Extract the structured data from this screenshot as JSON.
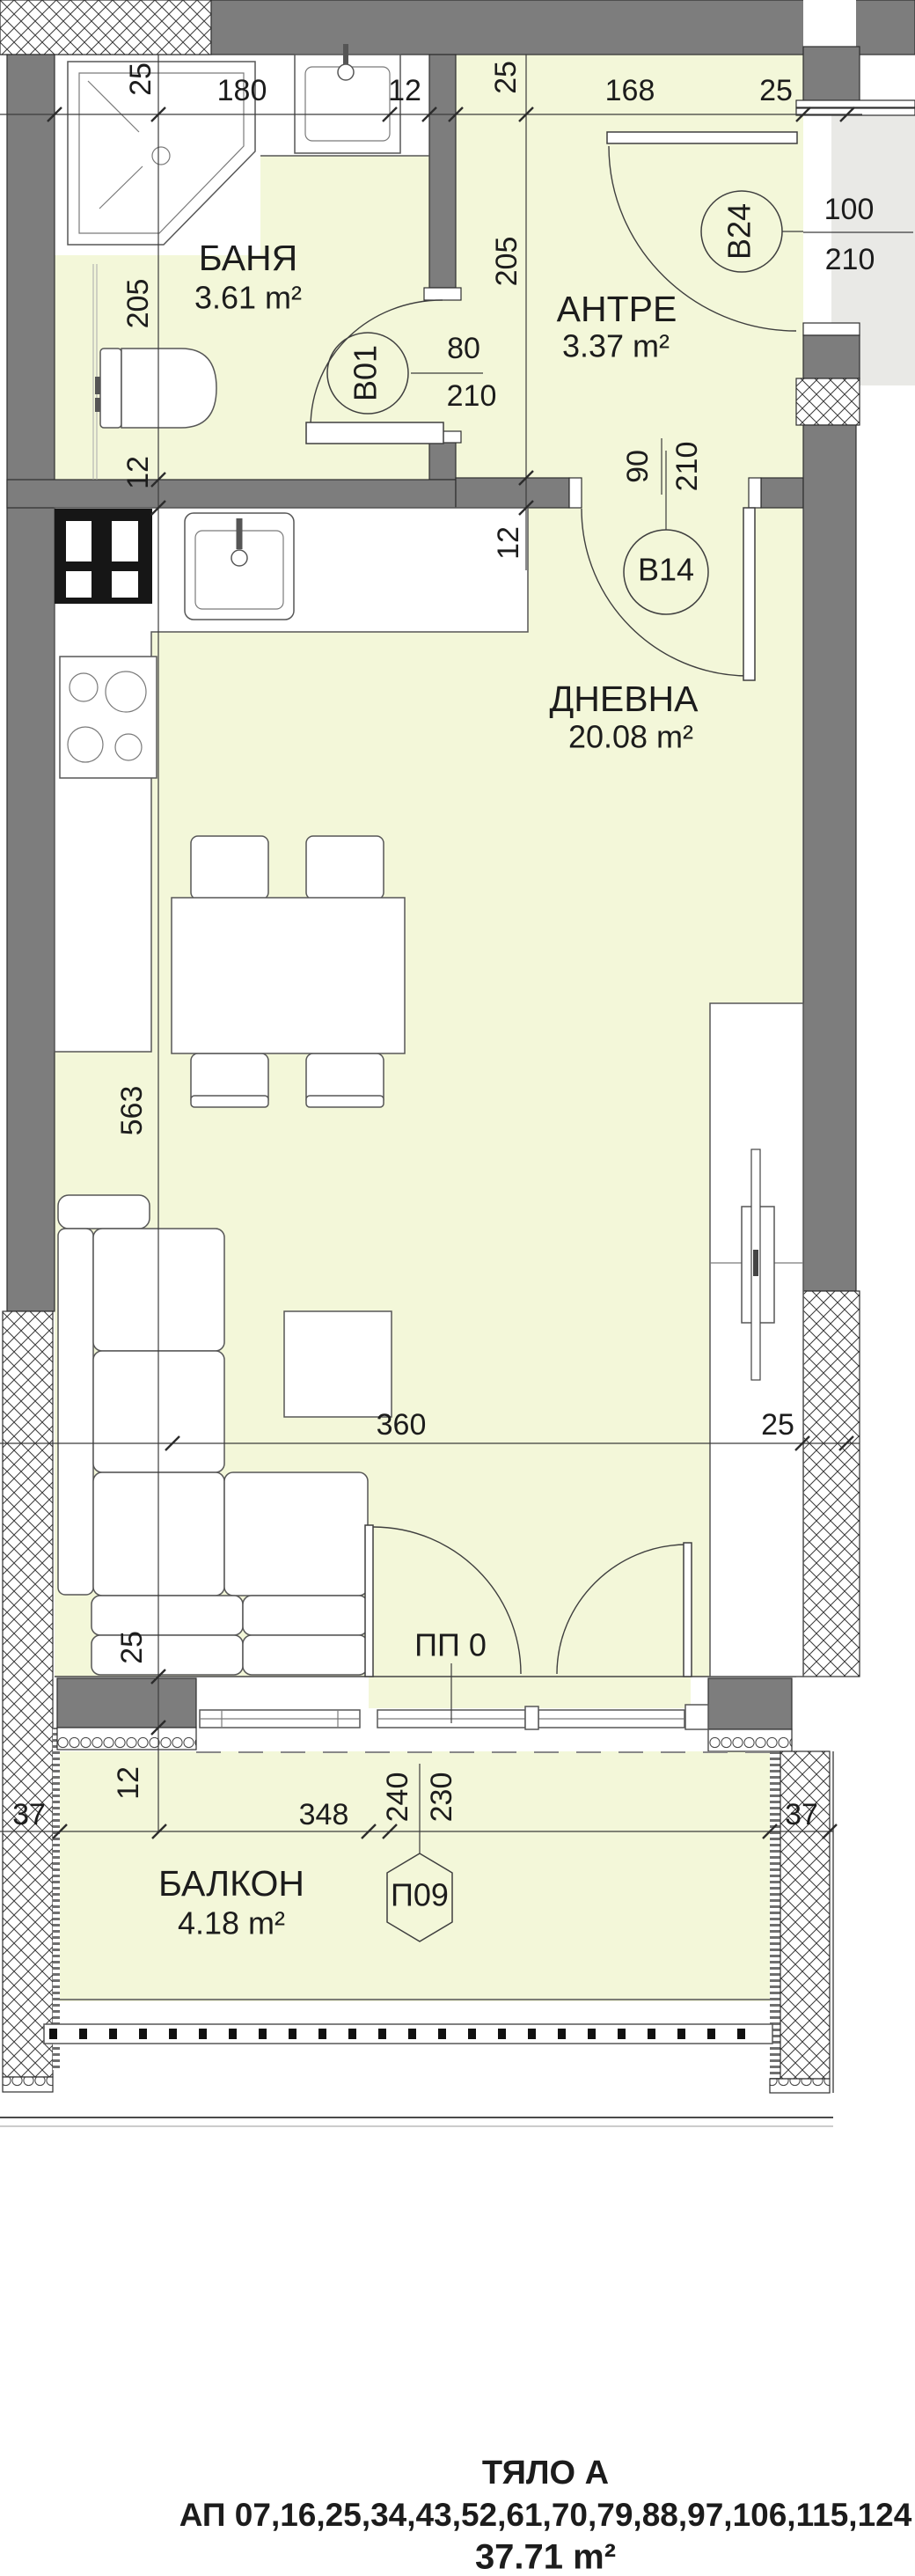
{
  "rooms": {
    "banya": {
      "name": "БАНЯ",
      "area": "3.61 m²"
    },
    "antre": {
      "name": "АНТРЕ",
      "area": "3.37 m²"
    },
    "dnevna": {
      "name": "ДНЕВНА",
      "area": "20.08 m²"
    },
    "balkon": {
      "name": "БАЛКОН",
      "area": "4.18 m²"
    }
  },
  "doors": {
    "b01": {
      "id": "B01",
      "w": "80",
      "h": "210"
    },
    "b14": {
      "id": "B14",
      "w": "90",
      "h": "210"
    },
    "b24": {
      "id": "B24",
      "w": "100",
      "h": "210"
    },
    "p09": {
      "id": "П09"
    },
    "pp0": {
      "id": "ПП 0"
    }
  },
  "dims": {
    "top": {
      "w25l": "25",
      "w180": "180",
      "w12": "12",
      "w25m": "25",
      "w168": "168",
      "w25r": "25"
    },
    "left": {
      "l205": "205",
      "l12": "12",
      "l563": "563",
      "l25": "25",
      "lb12": "12"
    },
    "antre": {
      "a205": "205",
      "a12": "12"
    },
    "living": {
      "d360": "360",
      "d25": "25"
    },
    "balcony": {
      "b37l": "37",
      "b348": "348",
      "b240": "240",
      "b230": "230",
      "b37r": "37"
    }
  },
  "footer": {
    "line1": "ТЯЛО А",
    "line2": "АП 07,16,25,34,43,52,61,70,79,88,97,106,115,124",
    "line3": "37.71 m²"
  },
  "colors": {
    "floor": "#f3f7d9",
    "wall": "#7d7d7d",
    "corridor": "#e9e9e6",
    "ink": "#1c1c1c"
  }
}
